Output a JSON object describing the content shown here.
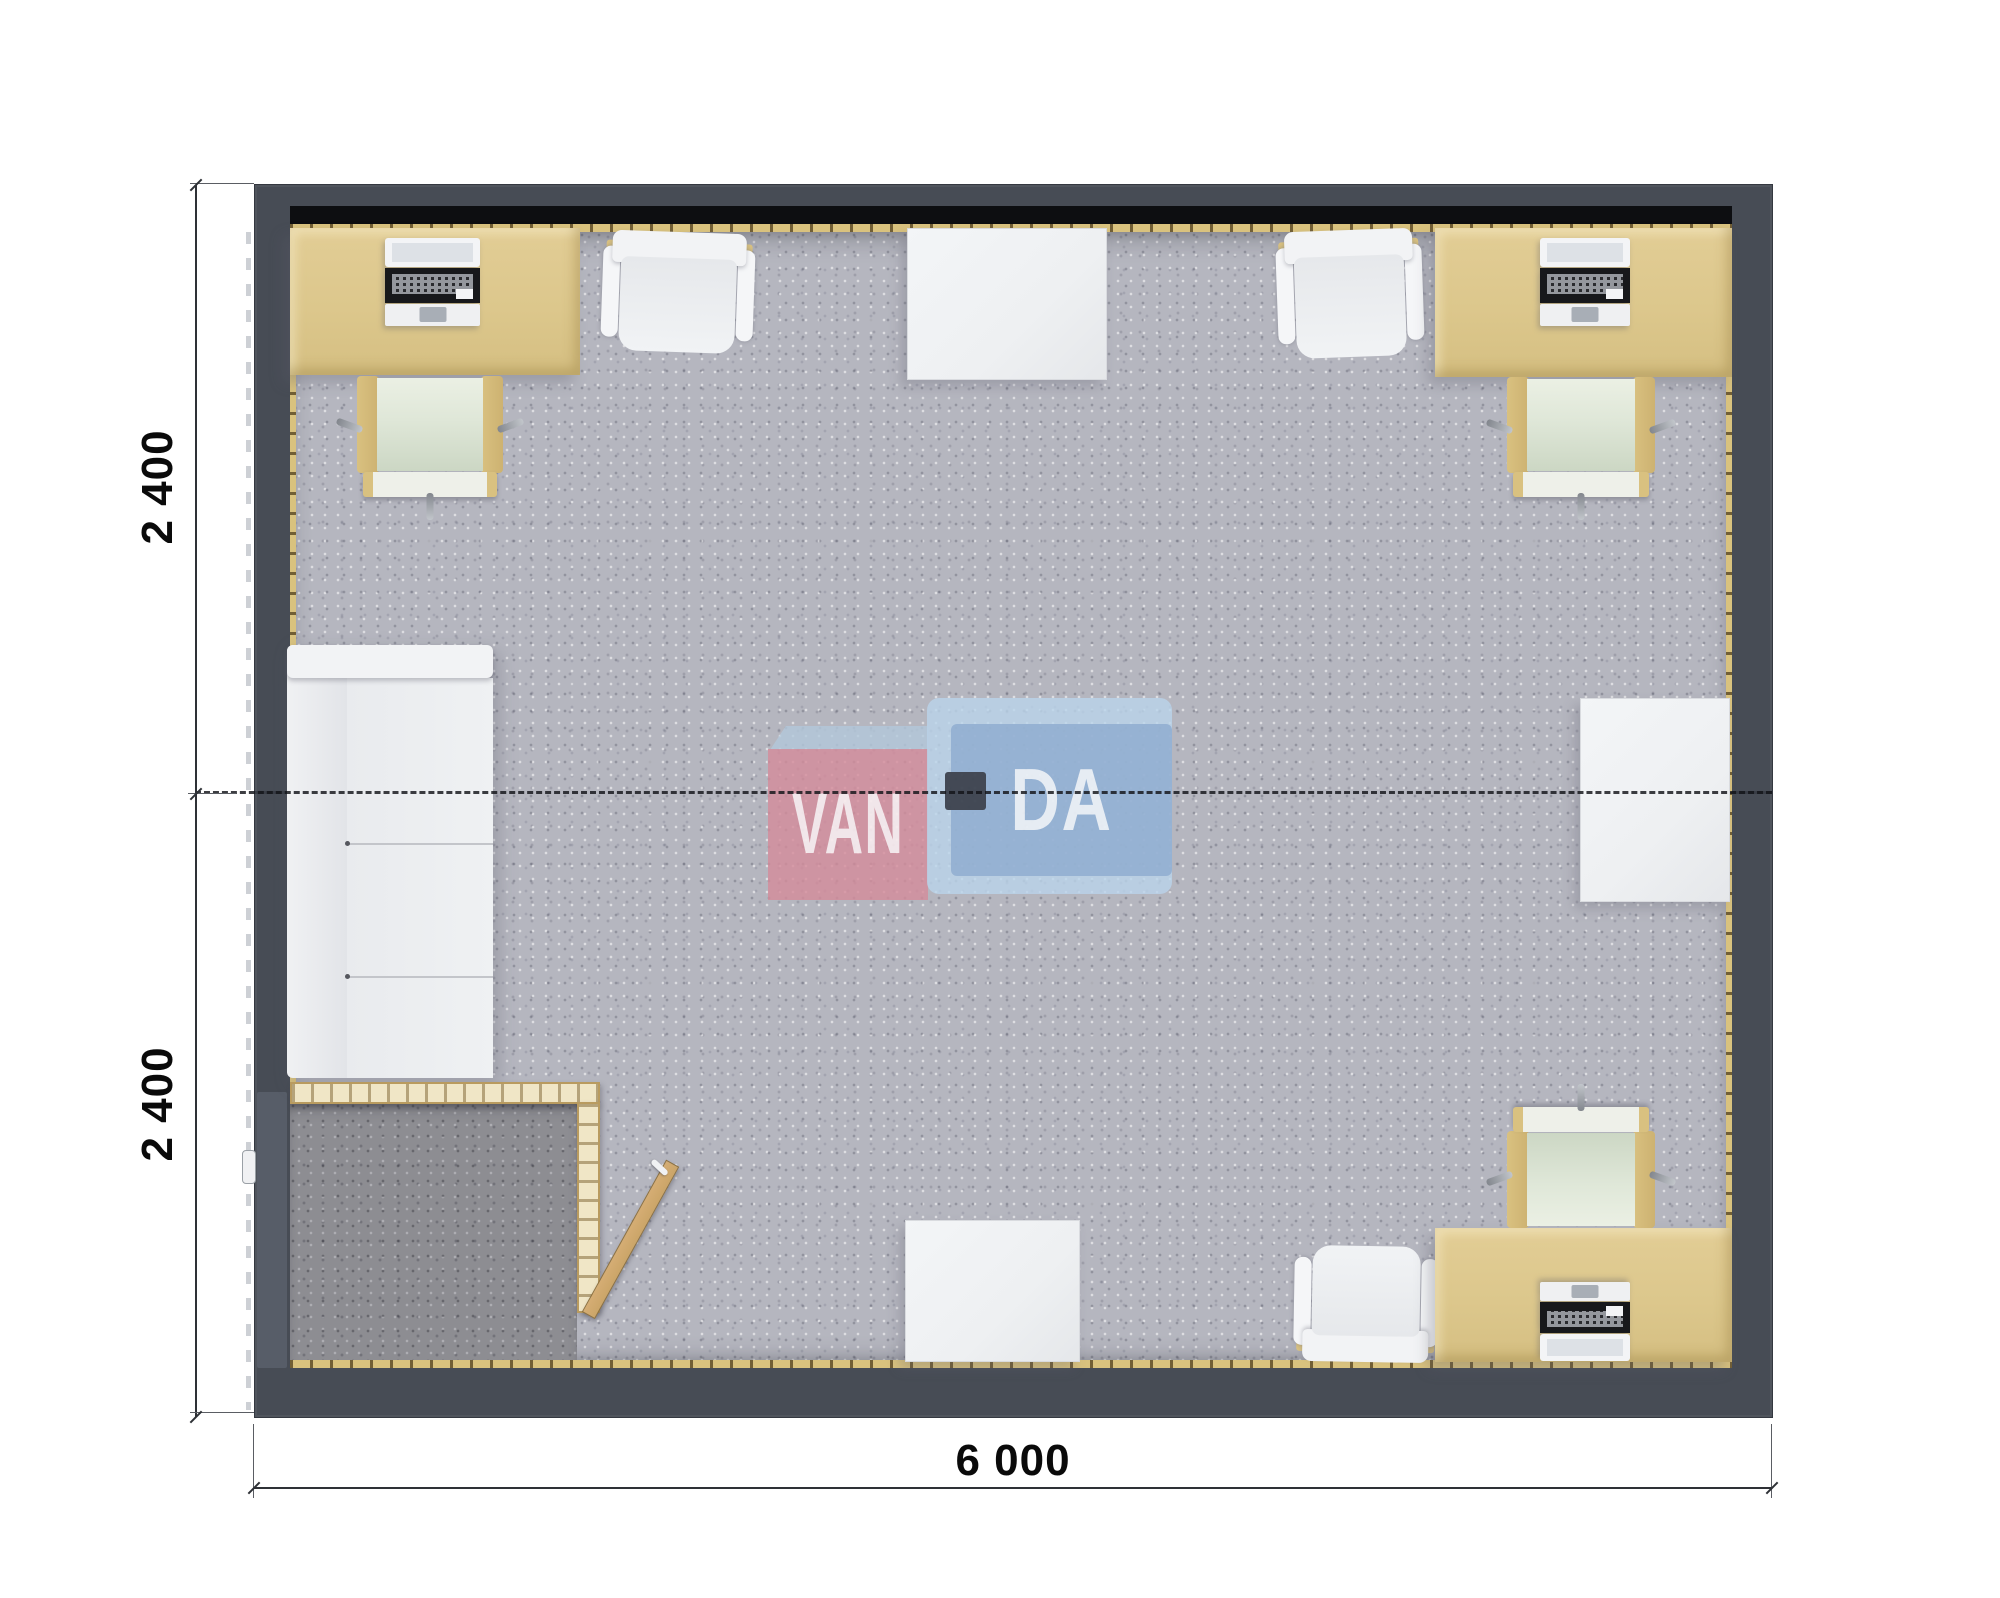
{
  "plan": {
    "type": "modular-office-floor-plan-top-view",
    "module_count_hint": "two joined 6000x2400 modules (dashed joint line across middle)"
  },
  "dimensions": {
    "left_top_label": "2 400",
    "left_bottom_label": "2 400",
    "bottom_label": "6 000"
  },
  "watermark": {
    "text_left": "VAN",
    "text_right": "DA"
  },
  "furniture": [
    {
      "name": "desk-top-left",
      "type": "desk-with-laptop"
    },
    {
      "name": "desk-chair-top-left",
      "type": "wood-frame-chair-green-seat"
    },
    {
      "name": "office-chair-top-left",
      "type": "white-armchair"
    },
    {
      "name": "table-top-center",
      "type": "white-table"
    },
    {
      "name": "office-chair-top-right",
      "type": "white-armchair"
    },
    {
      "name": "desk-top-right",
      "type": "desk-with-laptop"
    },
    {
      "name": "desk-chair-top-right",
      "type": "wood-frame-chair-green-seat"
    },
    {
      "name": "sofa-left",
      "type": "white-two-seat-sofa"
    },
    {
      "name": "side-table-right",
      "type": "white-table"
    },
    {
      "name": "entry-vestibule",
      "type": "partitioned-entry-with-open-door"
    },
    {
      "name": "table-bottom-center",
      "type": "white-table"
    },
    {
      "name": "office-chair-bottom",
      "type": "white-armchair"
    },
    {
      "name": "desk-bottom-right",
      "type": "desk-with-laptop"
    },
    {
      "name": "desk-chair-bottom-right",
      "type": "wood-frame-chair-green-seat"
    },
    {
      "name": "ceiling-lamp-center",
      "type": "dark-square-fixture"
    }
  ],
  "colors": {
    "wall": "#474c55",
    "wall_edge": "#343840",
    "black_line": "#0d0e11",
    "sill": "#d9c27e",
    "floor": "#b5b6bf",
    "vestibule_floor": "#8d8d92",
    "desk": "#dcc78c",
    "white_furn": "#eef0f2",
    "white_furn_shade": "#d9dbdf",
    "seat_green": "#dfe7d8",
    "chair_frame": "#d9c180",
    "wheel": "#82868d",
    "partition": "#f0e6c6",
    "partition_edge": "#b99b5f",
    "door": "#cba568",
    "dim": "#2e3136",
    "text": "#0a0a0a",
    "wm_pink": "#d48c9b",
    "wm_pink_top": "#b3c8da",
    "wm_blue": "#93b0d2",
    "wm_blue_light": "#bad3ea",
    "lamp": "#3d4450"
  }
}
